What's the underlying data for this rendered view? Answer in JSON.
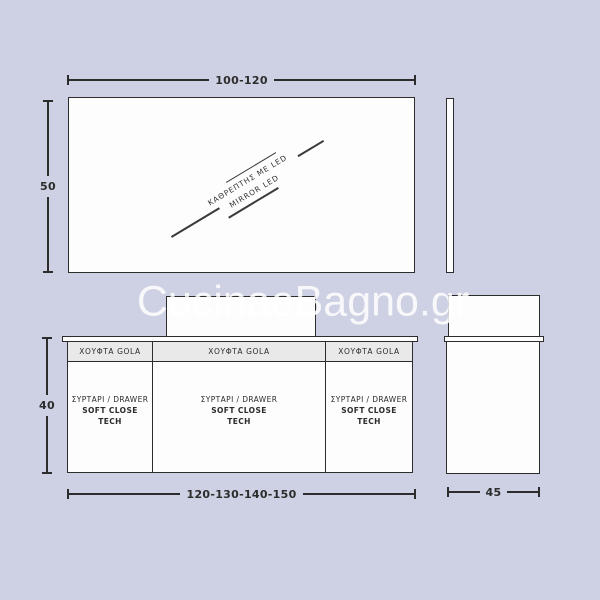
{
  "watermark": {
    "text": "CucinaeBagno.gr"
  },
  "mirror": {
    "width_label": "100-120",
    "height_label": "50",
    "diag_label_el": "ΚΑΘΡΕΠΤΗΣ ΜΕ LED",
    "diag_label_en": "MIRROR LED"
  },
  "vanity": {
    "width_label": "120-130-140-150",
    "height_label": "40",
    "depth_label": "45",
    "columns": [
      {
        "header": "ΧΟΥΦΤΑ GOLA",
        "drawer_line1": "ΣΥΡΤΑΡΙ / DRAWER",
        "drawer_line2": "SOFT CLOSE",
        "drawer_line3": "TECH"
      },
      {
        "header": "ΧΟΥΦΤΑ GOLA",
        "drawer_line1": "ΣΥΡΤΑΡΙ / DRAWER",
        "drawer_line2": "SOFT CLOSE",
        "drawer_line3": "TECH"
      },
      {
        "header": "ΧΟΥΦΤΑ GOLA",
        "drawer_line1": "ΣΥΡΤΑΡΙ / DRAWER",
        "drawer_line2": "SOFT CLOSE",
        "drawer_line3": "TECH"
      }
    ]
  },
  "colors": {
    "background": "#cdd1e3",
    "ink": "#2c2c2c",
    "header_fill": "#e9e9ea",
    "watermark": "#ffffff"
  }
}
